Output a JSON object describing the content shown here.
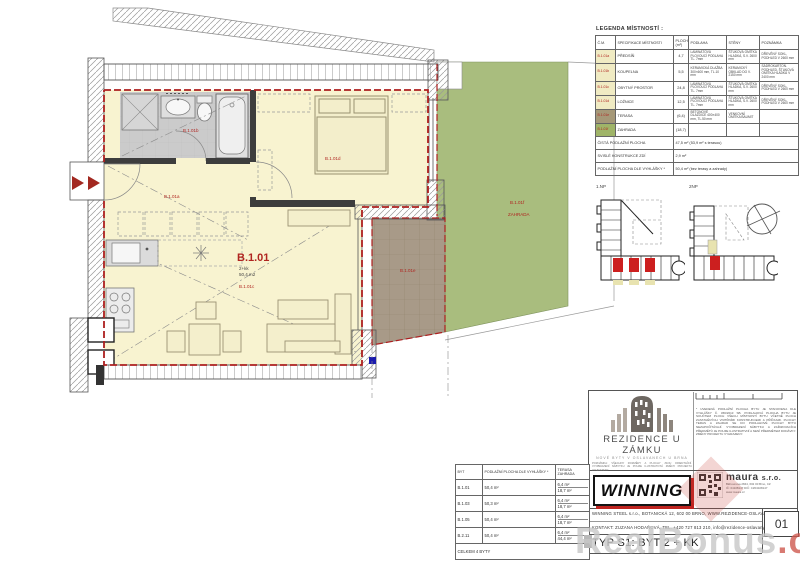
{
  "plan": {
    "labels": {
      "unit": "B.1.01",
      "type": "2+kk",
      "area": "50,4 m2",
      "room_c": "B.1.01c",
      "room_a": "B.1.01a",
      "room_b": "B.1.01b",
      "room_d": "B.1.01d",
      "room_e": "B.1.01e",
      "room_f": "B.1.01f",
      "garden": "ZAHRADA"
    },
    "colors": {
      "room_fill": "#f8f3d0",
      "bath_fill": "#cbcbcb",
      "terrace_fill": "#a89a88",
      "garden_fill": "#a9bd7e",
      "boundary_red": "#ad1f1f",
      "marker_blue": "#1a1aad"
    }
  },
  "legend": {
    "title": "LEGENDA MÍSTNOSTÍ :",
    "headers": [
      "Č.M.",
      "SPECIFIKACE MÍSTNOSTI",
      "PLOCHA (m²)",
      "PODLAHA",
      "STĚNY",
      "POZNÁMKA"
    ],
    "rows": [
      {
        "cm": "B.1.01a",
        "name": "PŘEDSÍŇ",
        "area": "4,7",
        "floor": "LAMINÁTOVÁ PLOVOUCÍ PODLAHA TL. 7mm",
        "walls": "ŠTUKOVÁ OMÍTKA HLADKÁ, S.V. 2600 mm",
        "note": "DŘEVĚNÝ SOKL, PODHLED V 2600 mm"
      },
      {
        "cm": "B.1.01b",
        "name": "KOUPELNA",
        "area": "5,5",
        "floor": "KERAMICKÁ DLAŽBA 300×600 mm, TL.10 mm",
        "walls": "KERAMICKÝ OBKLAD DO V. 2150 mm",
        "note": "SÁDROKARTON. PODHLED, ŠTUKOVÁ OMÍTKA HLADKÁ V 2400 mm"
      },
      {
        "cm": "B.1.01c",
        "name": "OBYTNÝ PROSTOR",
        "area": "24,8",
        "floor": "LAMINÁTOVÁ PLOVOUCÍ PODLAHA TL. 7mm",
        "walls": "ŠTUKOVÁ OMÍTKA HLADKÁ, S.V. 2600 mm",
        "note": "DŘEVĚNÝ SOKL, PODHLED V 2600 mm"
      },
      {
        "cm": "B.1.01d",
        "name": "LOŽNICE",
        "area": "12,5",
        "floor": "LAMINÁTOVÁ PLOVOUCÍ PODLAHA TL. 7mm",
        "walls": "ŠTUKOVÁ OMÍTKA HLADKÁ, S.V. 2600 mm",
        "note": "DŘEVĚNÝ SOKL, PODHLED V 2600 mm"
      },
      {
        "cm": "B.1.01e",
        "name": "TERASA",
        "area": "(6,4)",
        "floor": "BETONOVÉ DLAŽDICE 400×400 mm, TL.50 mm",
        "walls": "VENKOVNÍ OMÍTKA BAUMIT",
        "note": ""
      },
      {
        "cm": "B.1.01f",
        "name": "ZAHRADA",
        "area": "(18,7)",
        "floor": "",
        "walls": "",
        "note": ""
      }
    ],
    "summary": [
      {
        "label": "ČISTÁ PODLAŽNÍ PLOCHA",
        "value": "47,5 m²   (53,9 m² s terasou)"
      },
      {
        "label": "SVISLÉ KONSTRUKCE ZDÍ",
        "value": "2,9 m²"
      },
      {
        "label": "PODLAŽNÍ PLOCHA DLE VYHLÁŠKY *",
        "value": "50,4 m²   (bez terasy a zahrady)"
      }
    ]
  },
  "overview": {
    "left_label": "1.NP",
    "right_label": "2NP"
  },
  "titleblock": {
    "rezidence_title": "REZIDENCE U ZÁMKU",
    "rezidence_sub": "NOVÉ BYTY V OSLAVANECH U BRNA",
    "rezidence_note": "POZNÁMKA: VŠECHNY ROZMĚRY A PLOCHY JSOU ORIENTAČNÍ. VYOBRAZENÍ NÁBYTKU JE POUZE ILUSTRATIVNÍ. ZMĚNY PROJEKTU VYHRAZENY.",
    "disclaimer": "* UVEDENÁ PODLAŽNÍ PLOCHA BYTU JE STANOVENA DLE VYHLÁŠKY Č. 366/2013 SB. PODLAHOVÁ PLOCHA BYTU JE SOUČTEM PLOCH VŠECH MÍSTNOSTÍ BYTU VČETNĚ PLOCH ZASTAVĚNÝCH VNITŘNÍMI KONSTRUKCEMI A PŘÍČKAMI. PLOCHY TERAS A ZAHRAD SE DO PODLAHOVÉ PLOCHY BYTU NEZAPOČÍTÁVAJÍ. VYOBRAZENÍ NÁBYTKU A ZAŘIZOVACÍCH PŘEDMĚTŮ JE POUZE ILUSTRATIVNÍ A NENÍ PŘEDMĚTEM DODÁVKY. ZMĚNY PROJEKTU VYHRAZENY.",
    "winning_logo": "WINNING",
    "maura_name": "maura",
    "maura_sro": "s.r.o.",
    "maura_addr": "Běhounova 2844, 602 00 Brno, CZ",
    "maura_ic": "IČ: 04108147  DIČ: CZ04108147",
    "maura_web": "www.maura.cz",
    "winning_line": "WINNING STEEL s.r.o., BOTANICKÁ 12, 602 00 BRNO, WWW.REZIDENCE-OSLAVANY.CZ",
    "kontakt_line": "KONTAKT: ZUZANA HODAŇOVÁ, TEL. +420 727 813 210, info@rezidence-oslavany.cz",
    "typ_line": "TYP S1: BYT 2 + KK",
    "page": "01"
  },
  "apartments_table": {
    "headers": [
      "BYT",
      "PODLAŽNÍ PLOCHA DLE VYHLÁŠKY *",
      "TERASA ZAHRADA"
    ],
    "rows": [
      {
        "byt": "B.1.01",
        "plocha": "50,4 m²",
        "terasa": "6,4 m²",
        "zahrada": "18,7 m²"
      },
      {
        "byt": "B.1.03",
        "plocha": "50,3 m²",
        "terasa": "6,4 m²",
        "zahrada": "18,7 m²"
      },
      {
        "byt": "B.1.05",
        "plocha": "50,4 m²",
        "terasa": "6,4 m²",
        "zahrada": "18,7 m²"
      },
      {
        "byt": "B.2.11",
        "plocha": "50,4 m²",
        "terasa": "6,4 m²",
        "zahrada": "44,4 m²"
      }
    ],
    "footer": "CELKEM 4 BYTY"
  },
  "watermark": {
    "text_gray": "RealBonus",
    "text_red": ".cz"
  }
}
